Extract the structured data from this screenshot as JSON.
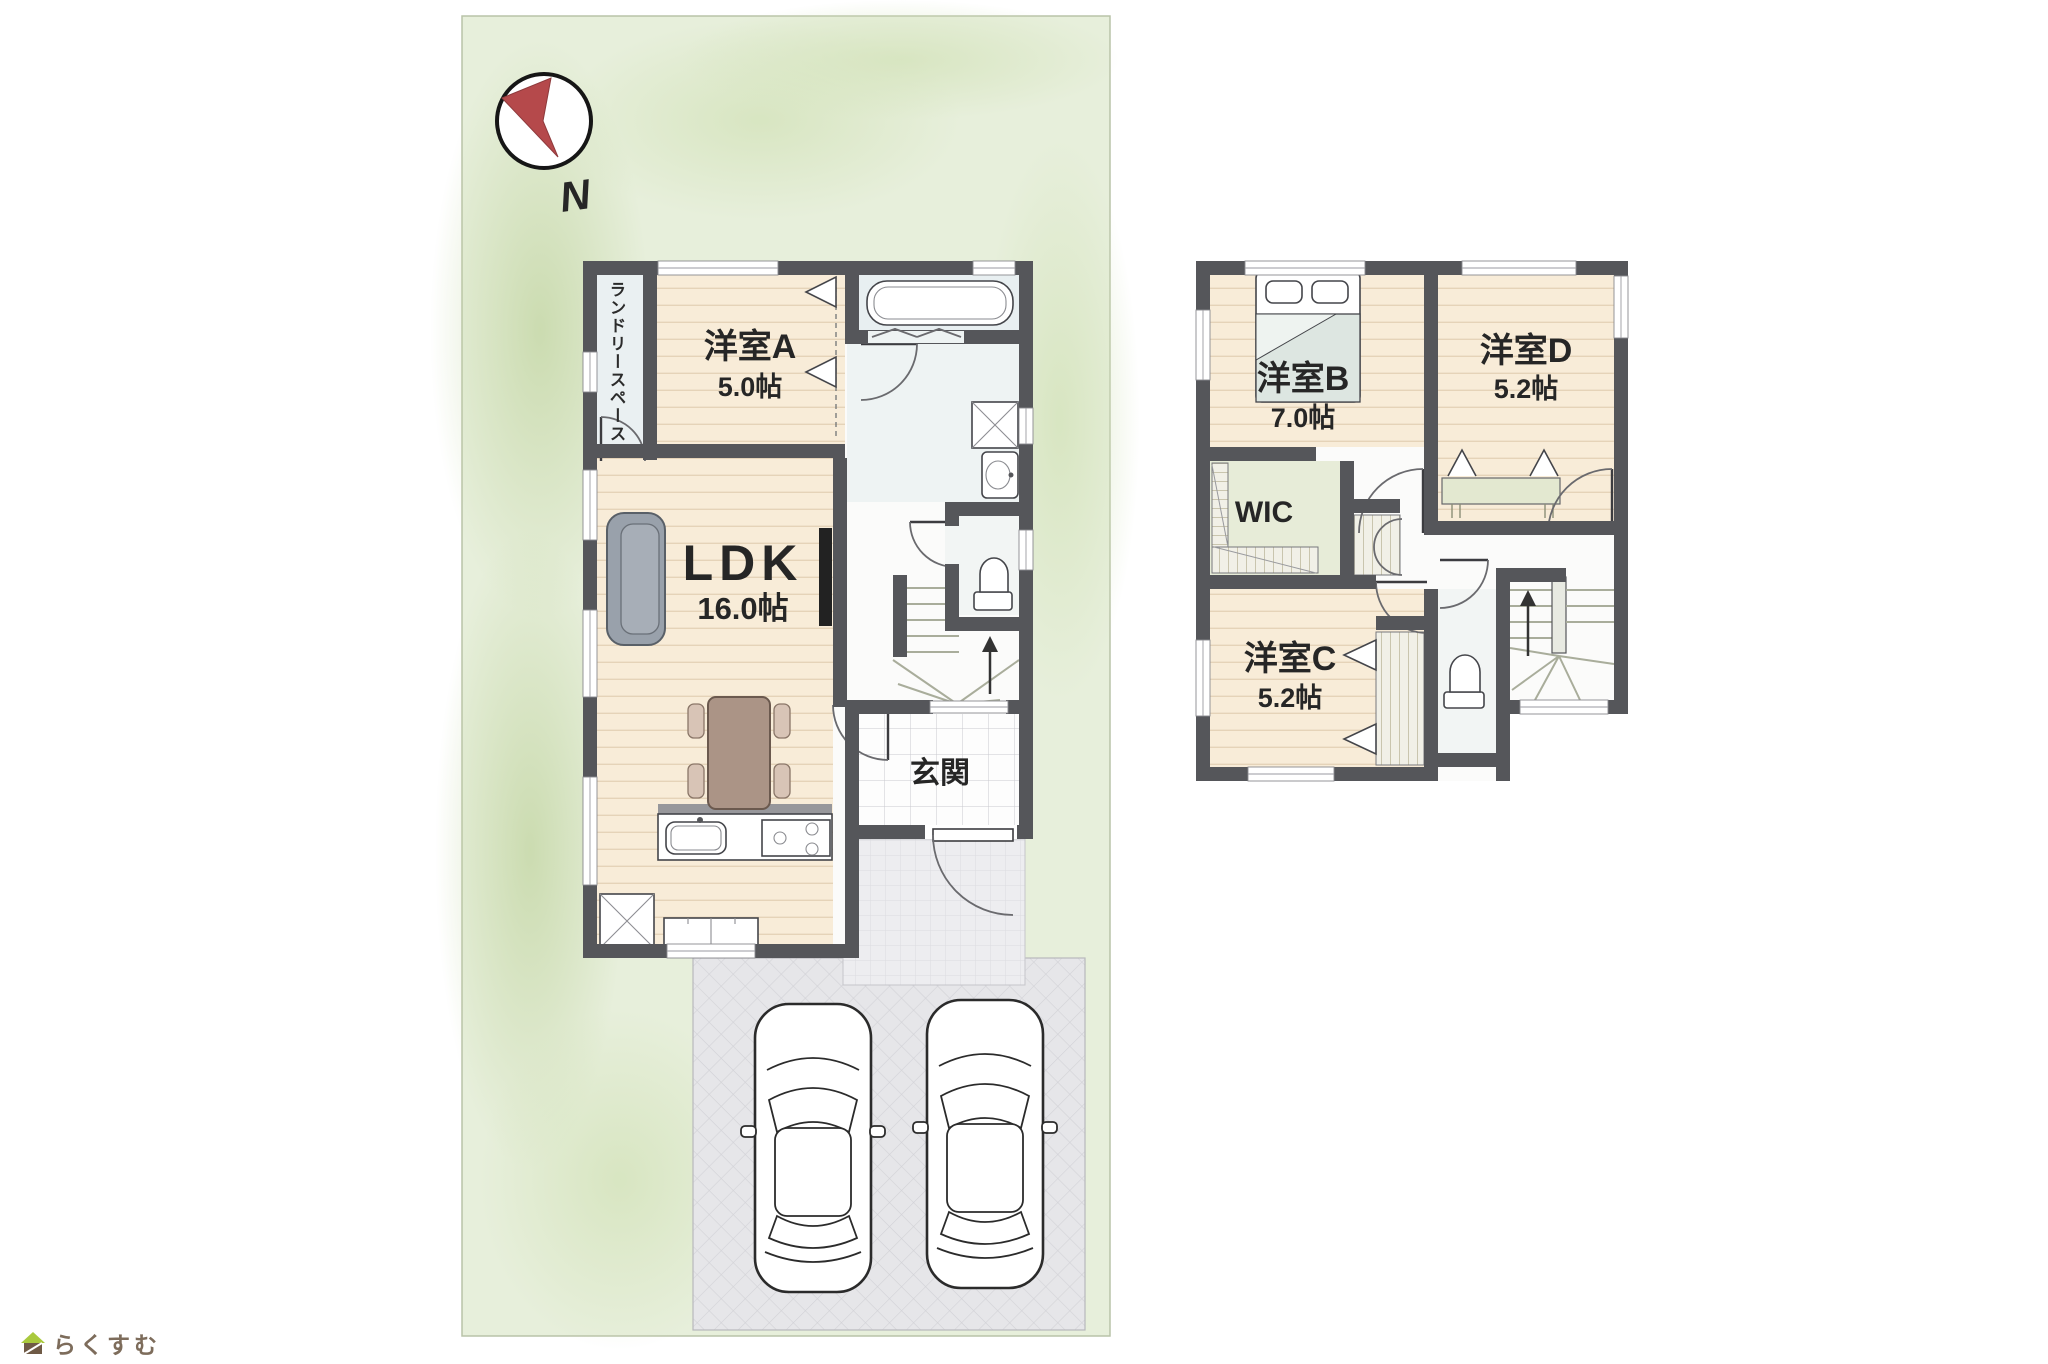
{
  "compass": {
    "label": "N"
  },
  "floor1": {
    "laundry": {
      "label": "ランドリースペース"
    },
    "room_a": {
      "label": "洋室A",
      "size": "5.0帖"
    },
    "ldk": {
      "label": "LDK",
      "size": "16.0帖"
    },
    "genkan": {
      "label": "玄関"
    }
  },
  "floor2": {
    "room_b": {
      "label": "洋室B",
      "size": "7.0帖"
    },
    "room_d": {
      "label": "洋室D",
      "size": "5.2帖"
    },
    "wic": {
      "label": "WIC"
    },
    "room_c": {
      "label": "洋室C",
      "size": "5.2帖"
    }
  },
  "logo": {
    "text": "らくすむ"
  },
  "colors": {
    "wall": "#55565a",
    "site_green": "#e7efdb",
    "wood_floor": "#f8ecd8",
    "compass_red": "#b5494b",
    "driveway": "#e6e6e9"
  }
}
